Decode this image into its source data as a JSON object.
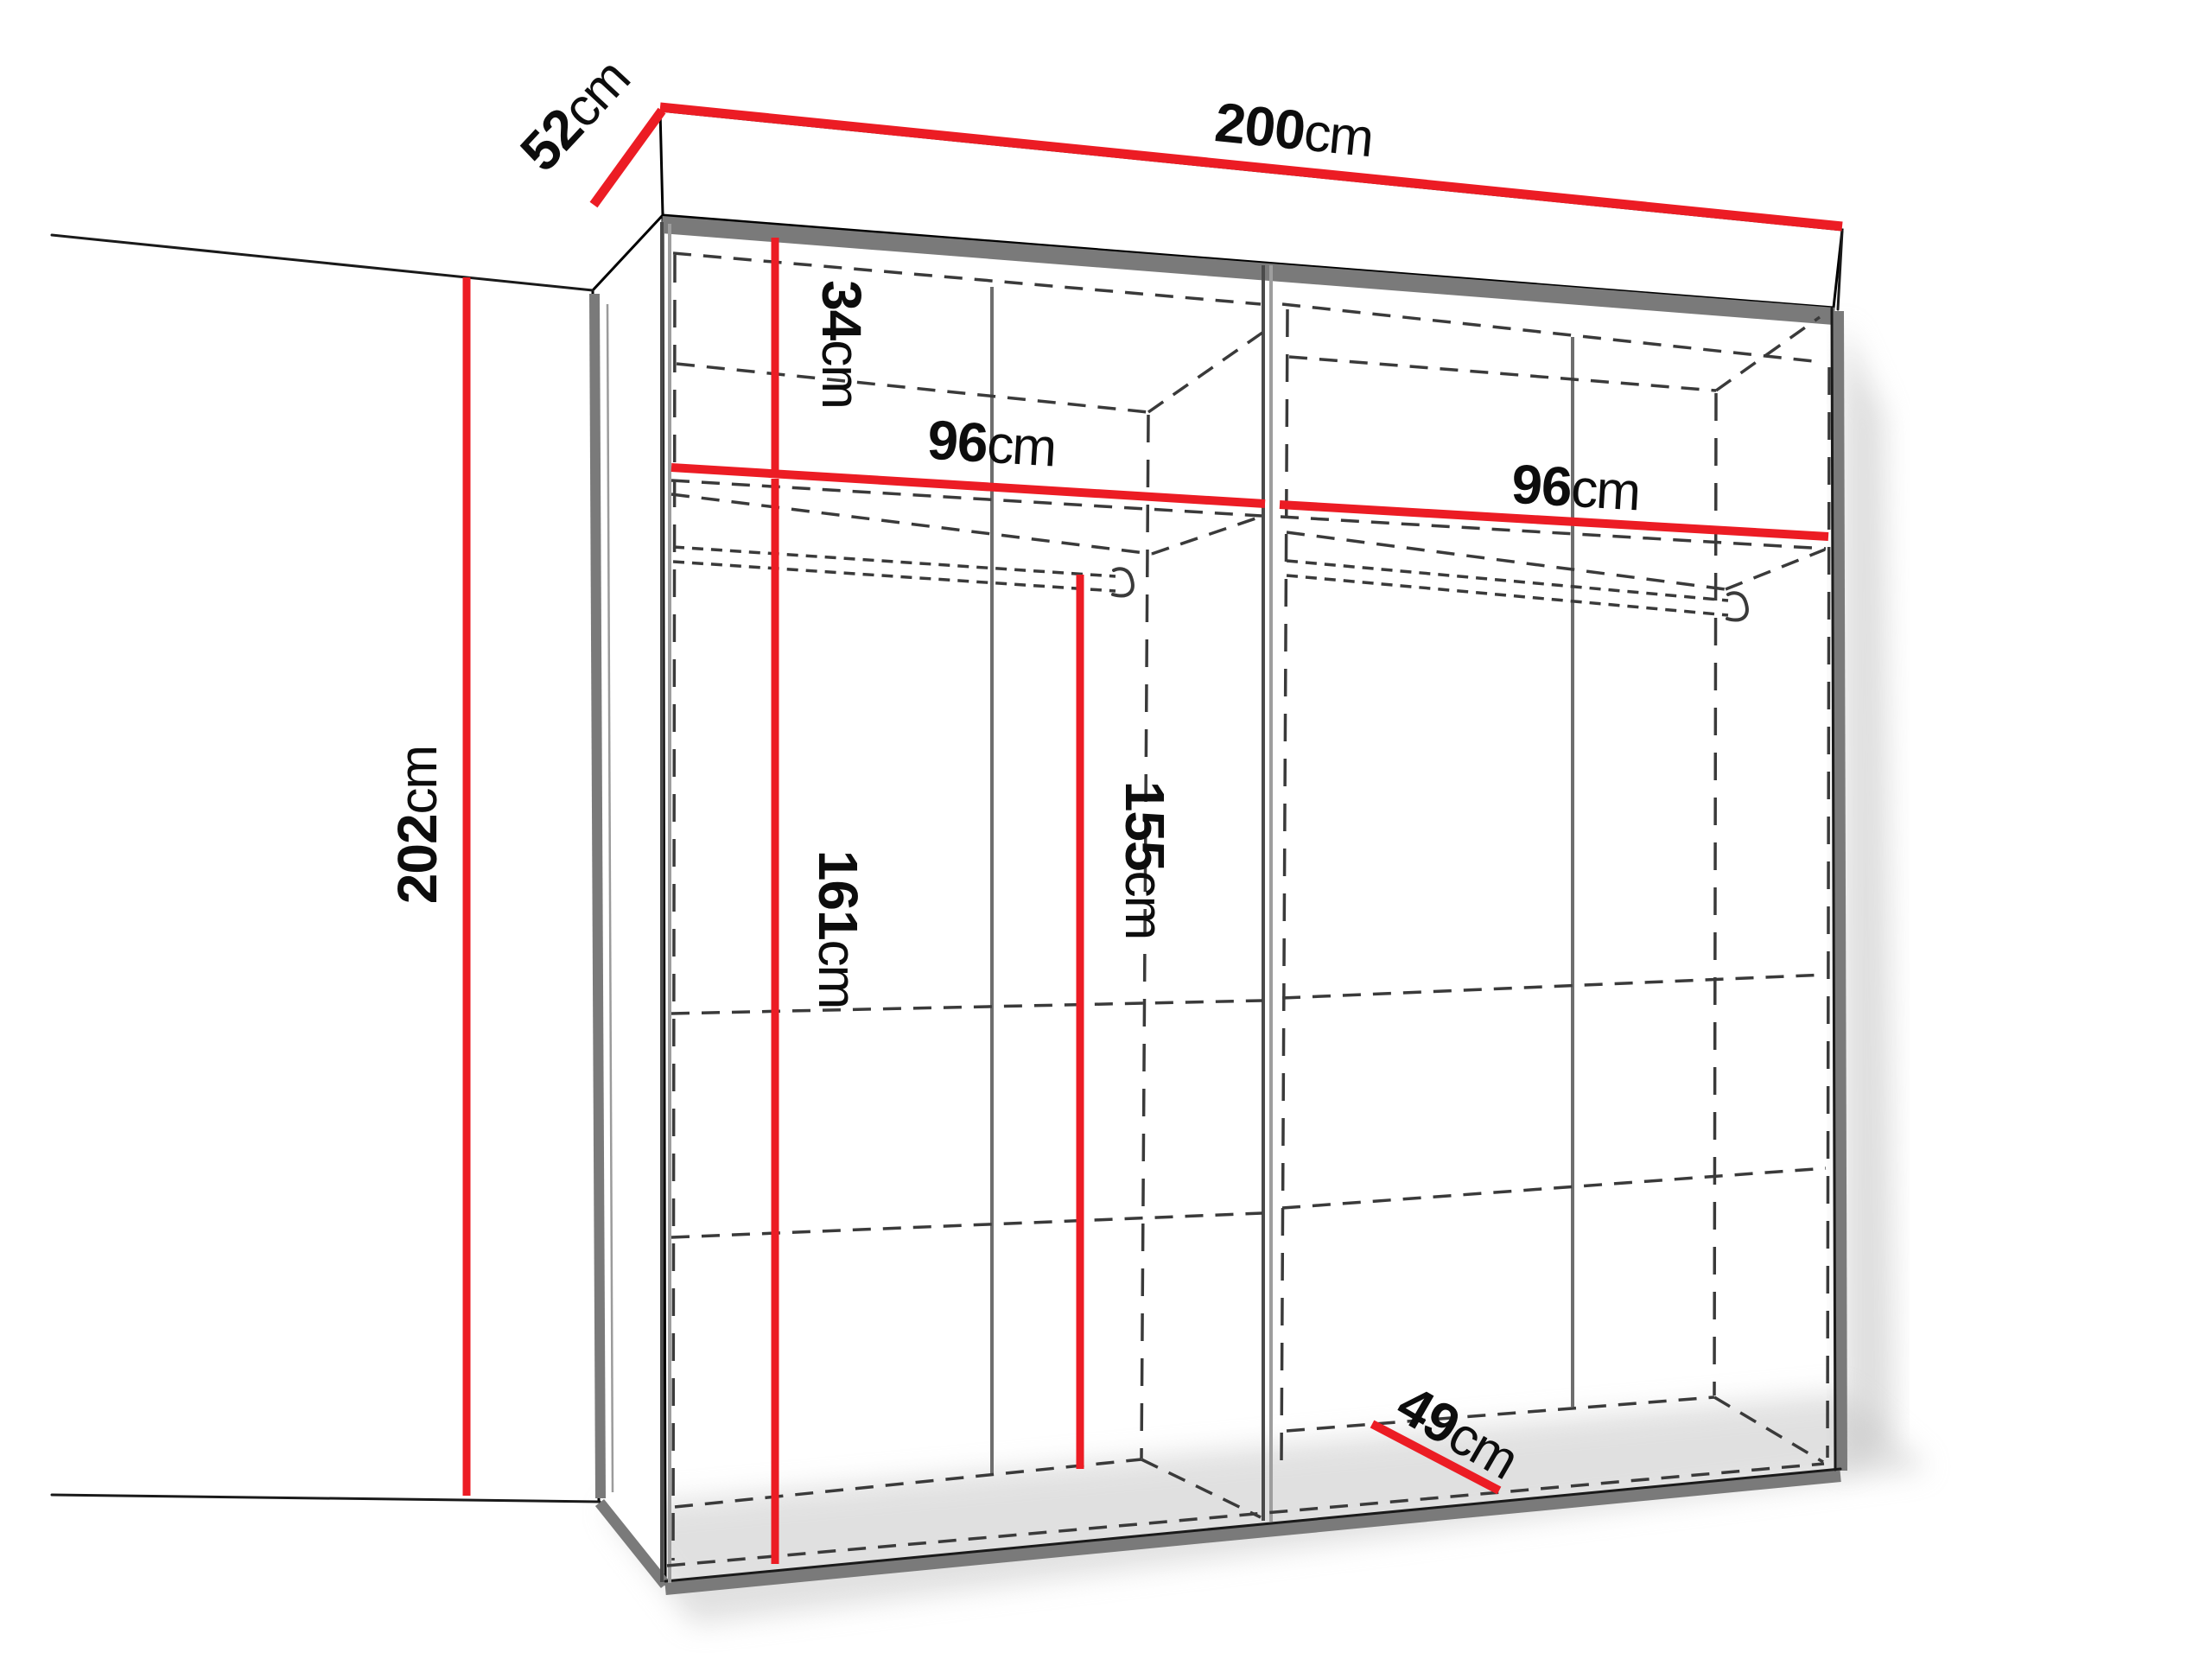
{
  "diagram": {
    "title": "wardrobe-dimension-diagram",
    "background_color": "#ffffff",
    "colors": {
      "dimension_line": "#EC1C24",
      "outline": "#000000",
      "panel_edge_gray": "#7a7a7a",
      "hidden_line_gray": "#3a3a3a"
    },
    "dims": {
      "width": {
        "value": "200",
        "unit": "cm"
      },
      "depth": {
        "value": "52",
        "unit": "cm"
      },
      "height": {
        "value": "202",
        "unit": "cm"
      },
      "top_shelf": {
        "value": "34",
        "unit": "cm"
      },
      "left_width": {
        "value": "96",
        "unit": "cm"
      },
      "right_width": {
        "value": "96",
        "unit": "cm"
      },
      "lower_height": {
        "value": "161",
        "unit": "cm"
      },
      "rod_height": {
        "value": "155",
        "unit": "cm"
      },
      "inner_depth": {
        "value": "49",
        "unit": "cm"
      }
    }
  }
}
